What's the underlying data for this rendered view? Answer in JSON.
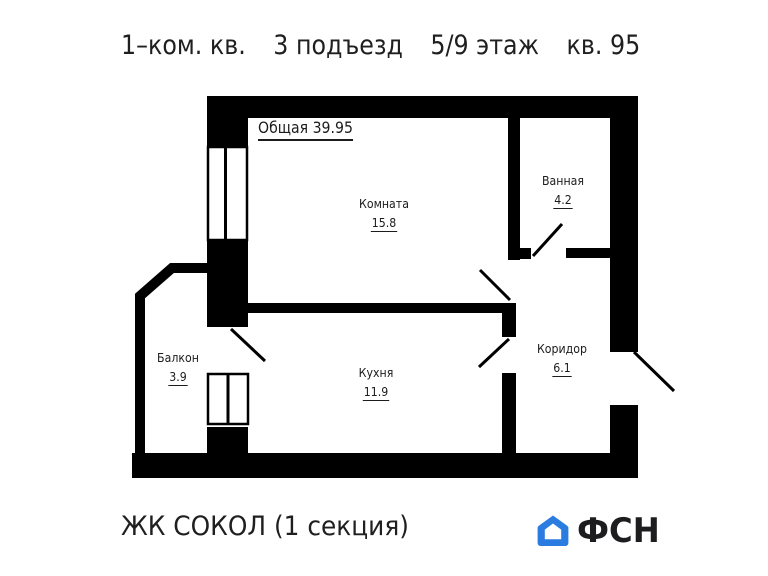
{
  "title": {
    "apartment_type": "1–ком. кв.",
    "entrance": "3 подъезд",
    "floor": "5/9 этаж",
    "apartment_number": "кв. 95"
  },
  "plan": {
    "total_area_label": "Общая 39.95",
    "rooms": {
      "komnata": {
        "name": "Комната",
        "area": "15.8"
      },
      "vannaya": {
        "name": "Ванная",
        "area": "4.2"
      },
      "kuhnya": {
        "name": "Кухня",
        "area": "11.9"
      },
      "koridor": {
        "name": "Коридор",
        "area": "6.1"
      },
      "balkon": {
        "name": "Балкон",
        "area": "3.9"
      }
    }
  },
  "footer": {
    "complex_name": "ЖК СОКОЛ (1 секция)",
    "logo_text": "ФСН"
  },
  "colors": {
    "walls": "#000000",
    "background": "#ffffff",
    "text": "#1c1c1c",
    "logo_blue": "#2a7ce0",
    "logo_text": "#1d1d1f"
  }
}
